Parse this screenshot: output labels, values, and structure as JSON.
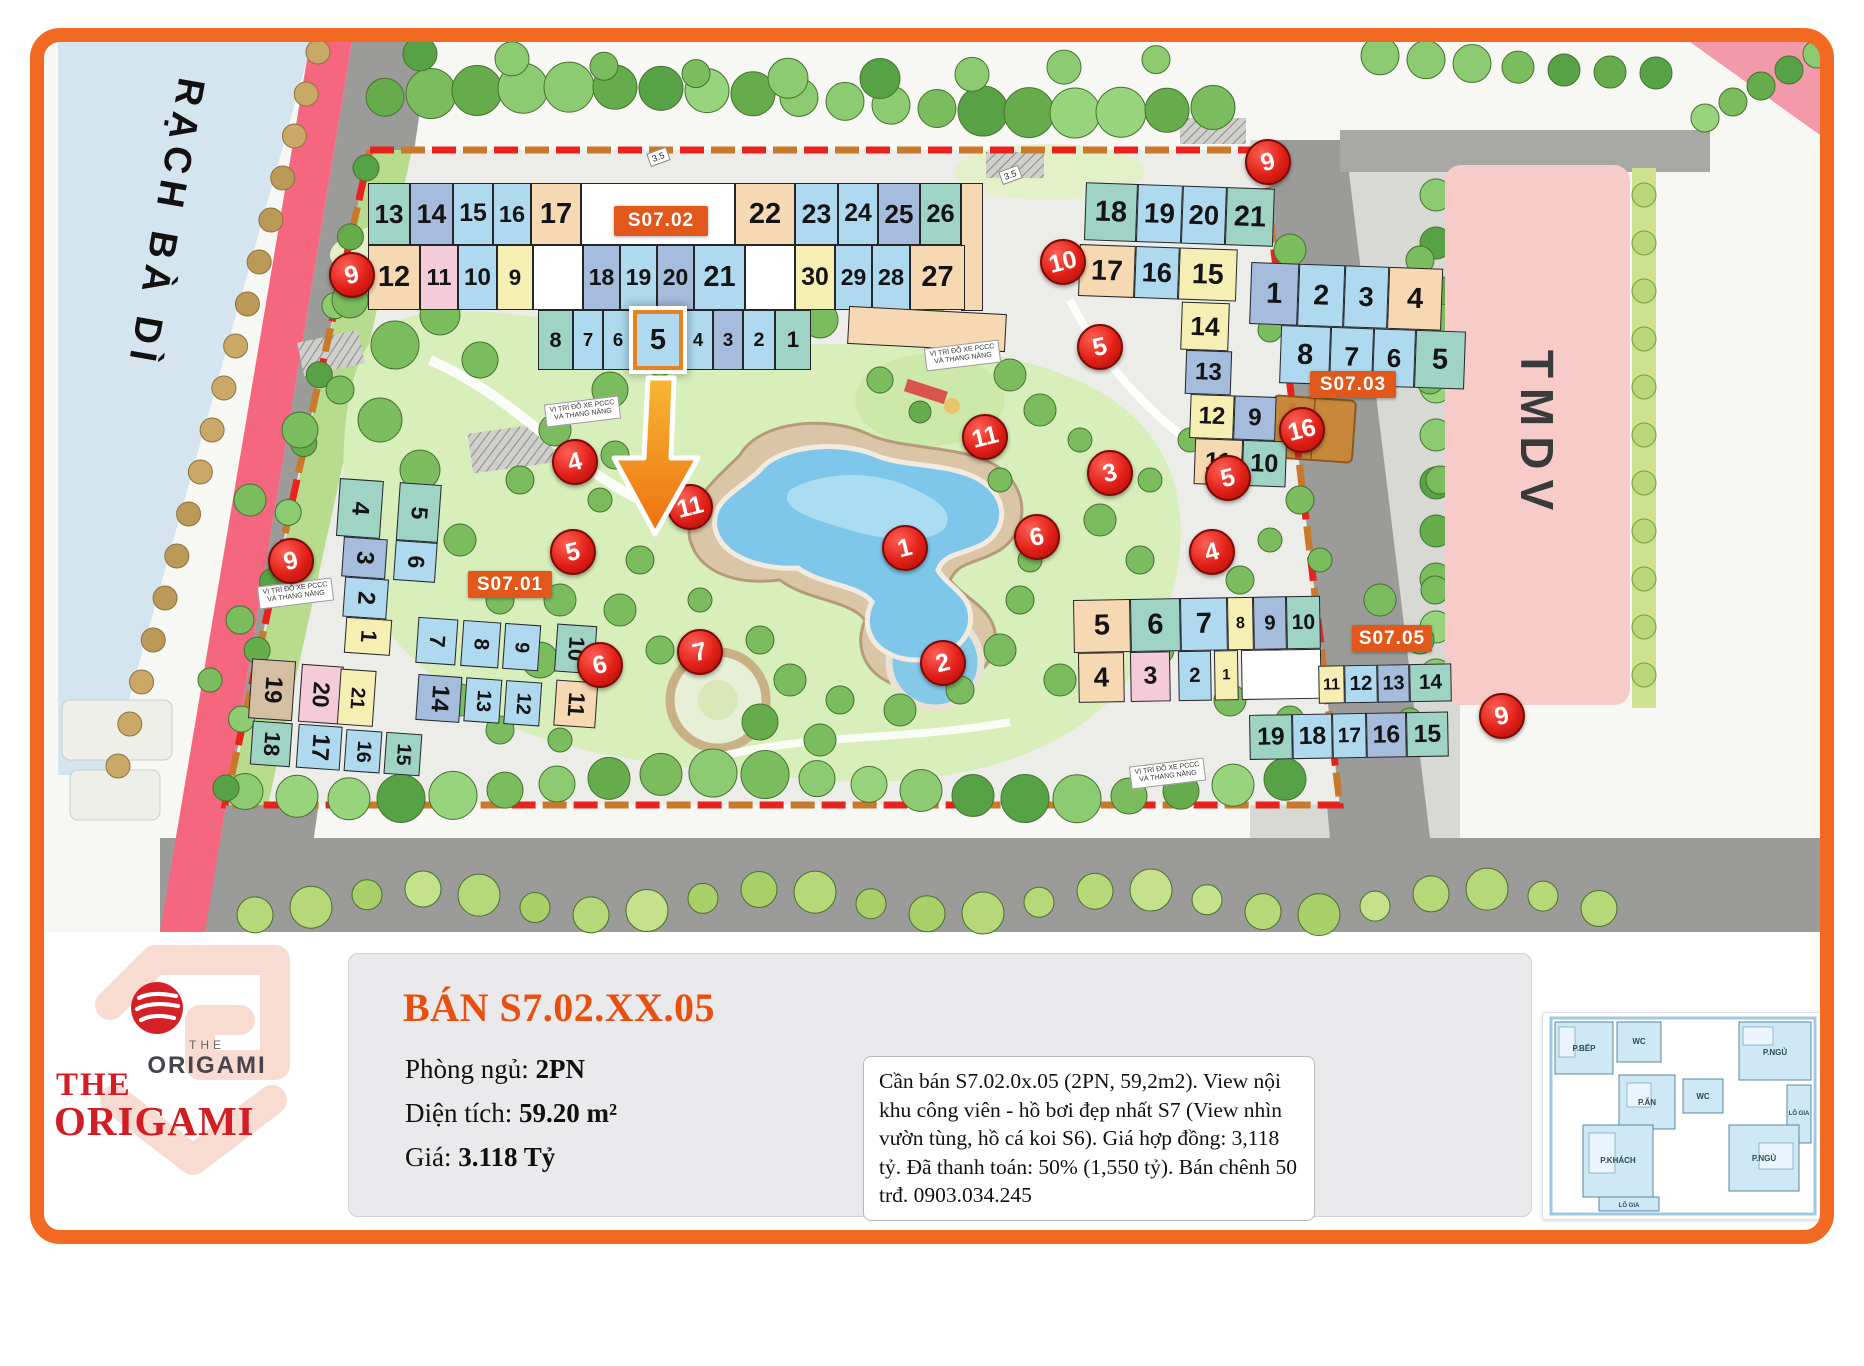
{
  "map": {
    "canal_label": "RẠCH BÀ DÌ",
    "tmdv_label": "TMDV",
    "parking_label_line1": "VỊ TRÍ ĐỖ XE PCCC",
    "parking_label_line2": "VÀ THANG NÂNG",
    "road_width_tag": "3.5",
    "highlight_unit": "5",
    "buildings": {
      "s0702": {
        "label": "S07.02",
        "rows": [
          [
            "13",
            "14",
            "15",
            "16",
            "17",
            "",
            "22",
            "23",
            "24",
            "25",
            "26",
            ""
          ],
          [
            "12",
            "11",
            "10",
            "9",
            "",
            "18",
            "19",
            "20",
            "21",
            "",
            "30",
            "29",
            "28",
            "27"
          ],
          [
            "8",
            "7",
            "6",
            "5",
            "4",
            "3",
            "2",
            "1"
          ]
        ]
      },
      "s0701": {
        "label": "S07.01",
        "units": [
          "4",
          "5",
          "3",
          "6",
          "2",
          "1",
          "7",
          "8",
          "9",
          "10",
          "11",
          "12",
          "13",
          "14",
          "19",
          "20",
          "21",
          "18",
          "17",
          "16",
          "15"
        ]
      },
      "s0703": {
        "label": "S07.03",
        "rows": [
          [
            "18",
            "19",
            "20",
            "21"
          ],
          [
            "17",
            "16",
            "15"
          ],
          [
            "1",
            "2",
            "3",
            "4"
          ],
          [
            "14"
          ],
          [
            "8",
            "7",
            "6",
            "5"
          ],
          [
            "13"
          ],
          [
            "12",
            "9"
          ],
          [
            "11",
            "10"
          ]
        ]
      },
      "s0705": {
        "label": "S07.05",
        "rows": [
          [
            "5",
            "6",
            "7",
            "8",
            "9",
            "10"
          ],
          [
            "4",
            "3",
            "2",
            "1",
            ""
          ],
          [
            "11",
            "12",
            "13",
            "14"
          ],
          [
            "19",
            "18",
            "17",
            "16",
            "15"
          ]
        ]
      }
    },
    "markers": [
      "9",
      "9",
      "4",
      "5",
      "11",
      "6",
      "7",
      "1",
      "2",
      "11",
      "3",
      "6",
      "10",
      "5",
      "5",
      "4",
      "16",
      "9",
      "9"
    ]
  },
  "panel": {
    "title": "BÁN S7.02.XX.05",
    "fields": [
      {
        "label": "Phòng ngủ:",
        "value": "2PN"
      },
      {
        "label": "Diện tích:",
        "value": "59.20 m²"
      },
      {
        "label": "Giá:",
        "value": "3.118 Tỷ"
      }
    ],
    "description": "Cần bán S7.02.0x.05 (2PN, 59,2m2). View nội khu công viên - hồ bơi đẹp nhất S7 (View nhìn vườn tùng, hồ cá koi S6). Giá hợp đồng: 3,118 tỷ. Đã thanh toán: 50% (1,550 tỷ). Bán chênh 50 trđ. 0903.034.245"
  },
  "logo": {
    "small_the": "THE",
    "small_name": "ORIGAMI",
    "big_the": "THE",
    "big_name": "ORIGAMI"
  },
  "floorplan": {
    "rooms": [
      "P.BẾP",
      "WC",
      "P.NGỦ",
      "P.ĂN",
      "WC",
      "LÔ GIA",
      "P.KHÁCH",
      "P.NGỦ",
      "LÔ GIA"
    ]
  },
  "colors": {
    "accent_orange": "#f26a21",
    "label_orange": "#e2571a",
    "marker_red": "#e01f17",
    "title_red": "#e8500f",
    "logo_red": "#d31d24",
    "pool_blue": "#7ec7ea",
    "canal_blue": "#d5e5f0",
    "road_pink": "#f4677e"
  }
}
